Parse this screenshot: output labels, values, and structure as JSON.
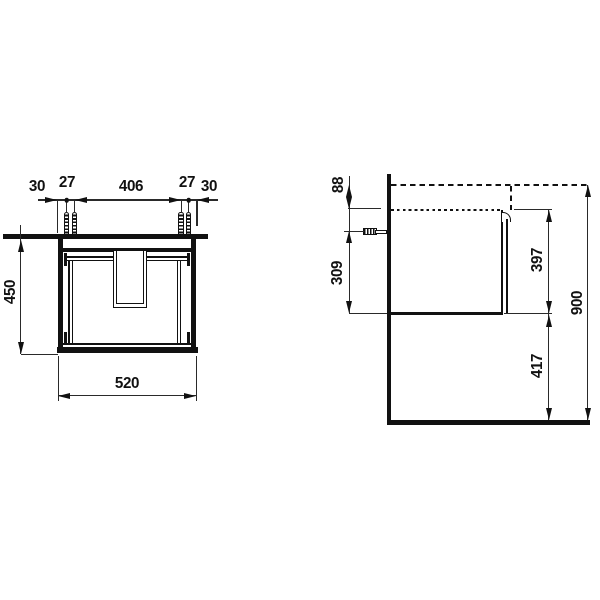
{
  "views": {
    "front": {
      "top_chain": [
        "30",
        "27",
        "406",
        "27",
        "30"
      ],
      "height": "450",
      "width": "520"
    },
    "side": {
      "top_offset": "88",
      "bracket_height": "309",
      "body_height": "397",
      "floor_clearance": "417",
      "total_height": "900"
    }
  },
  "colors": {
    "line": "#111111",
    "background": "#ffffff"
  }
}
